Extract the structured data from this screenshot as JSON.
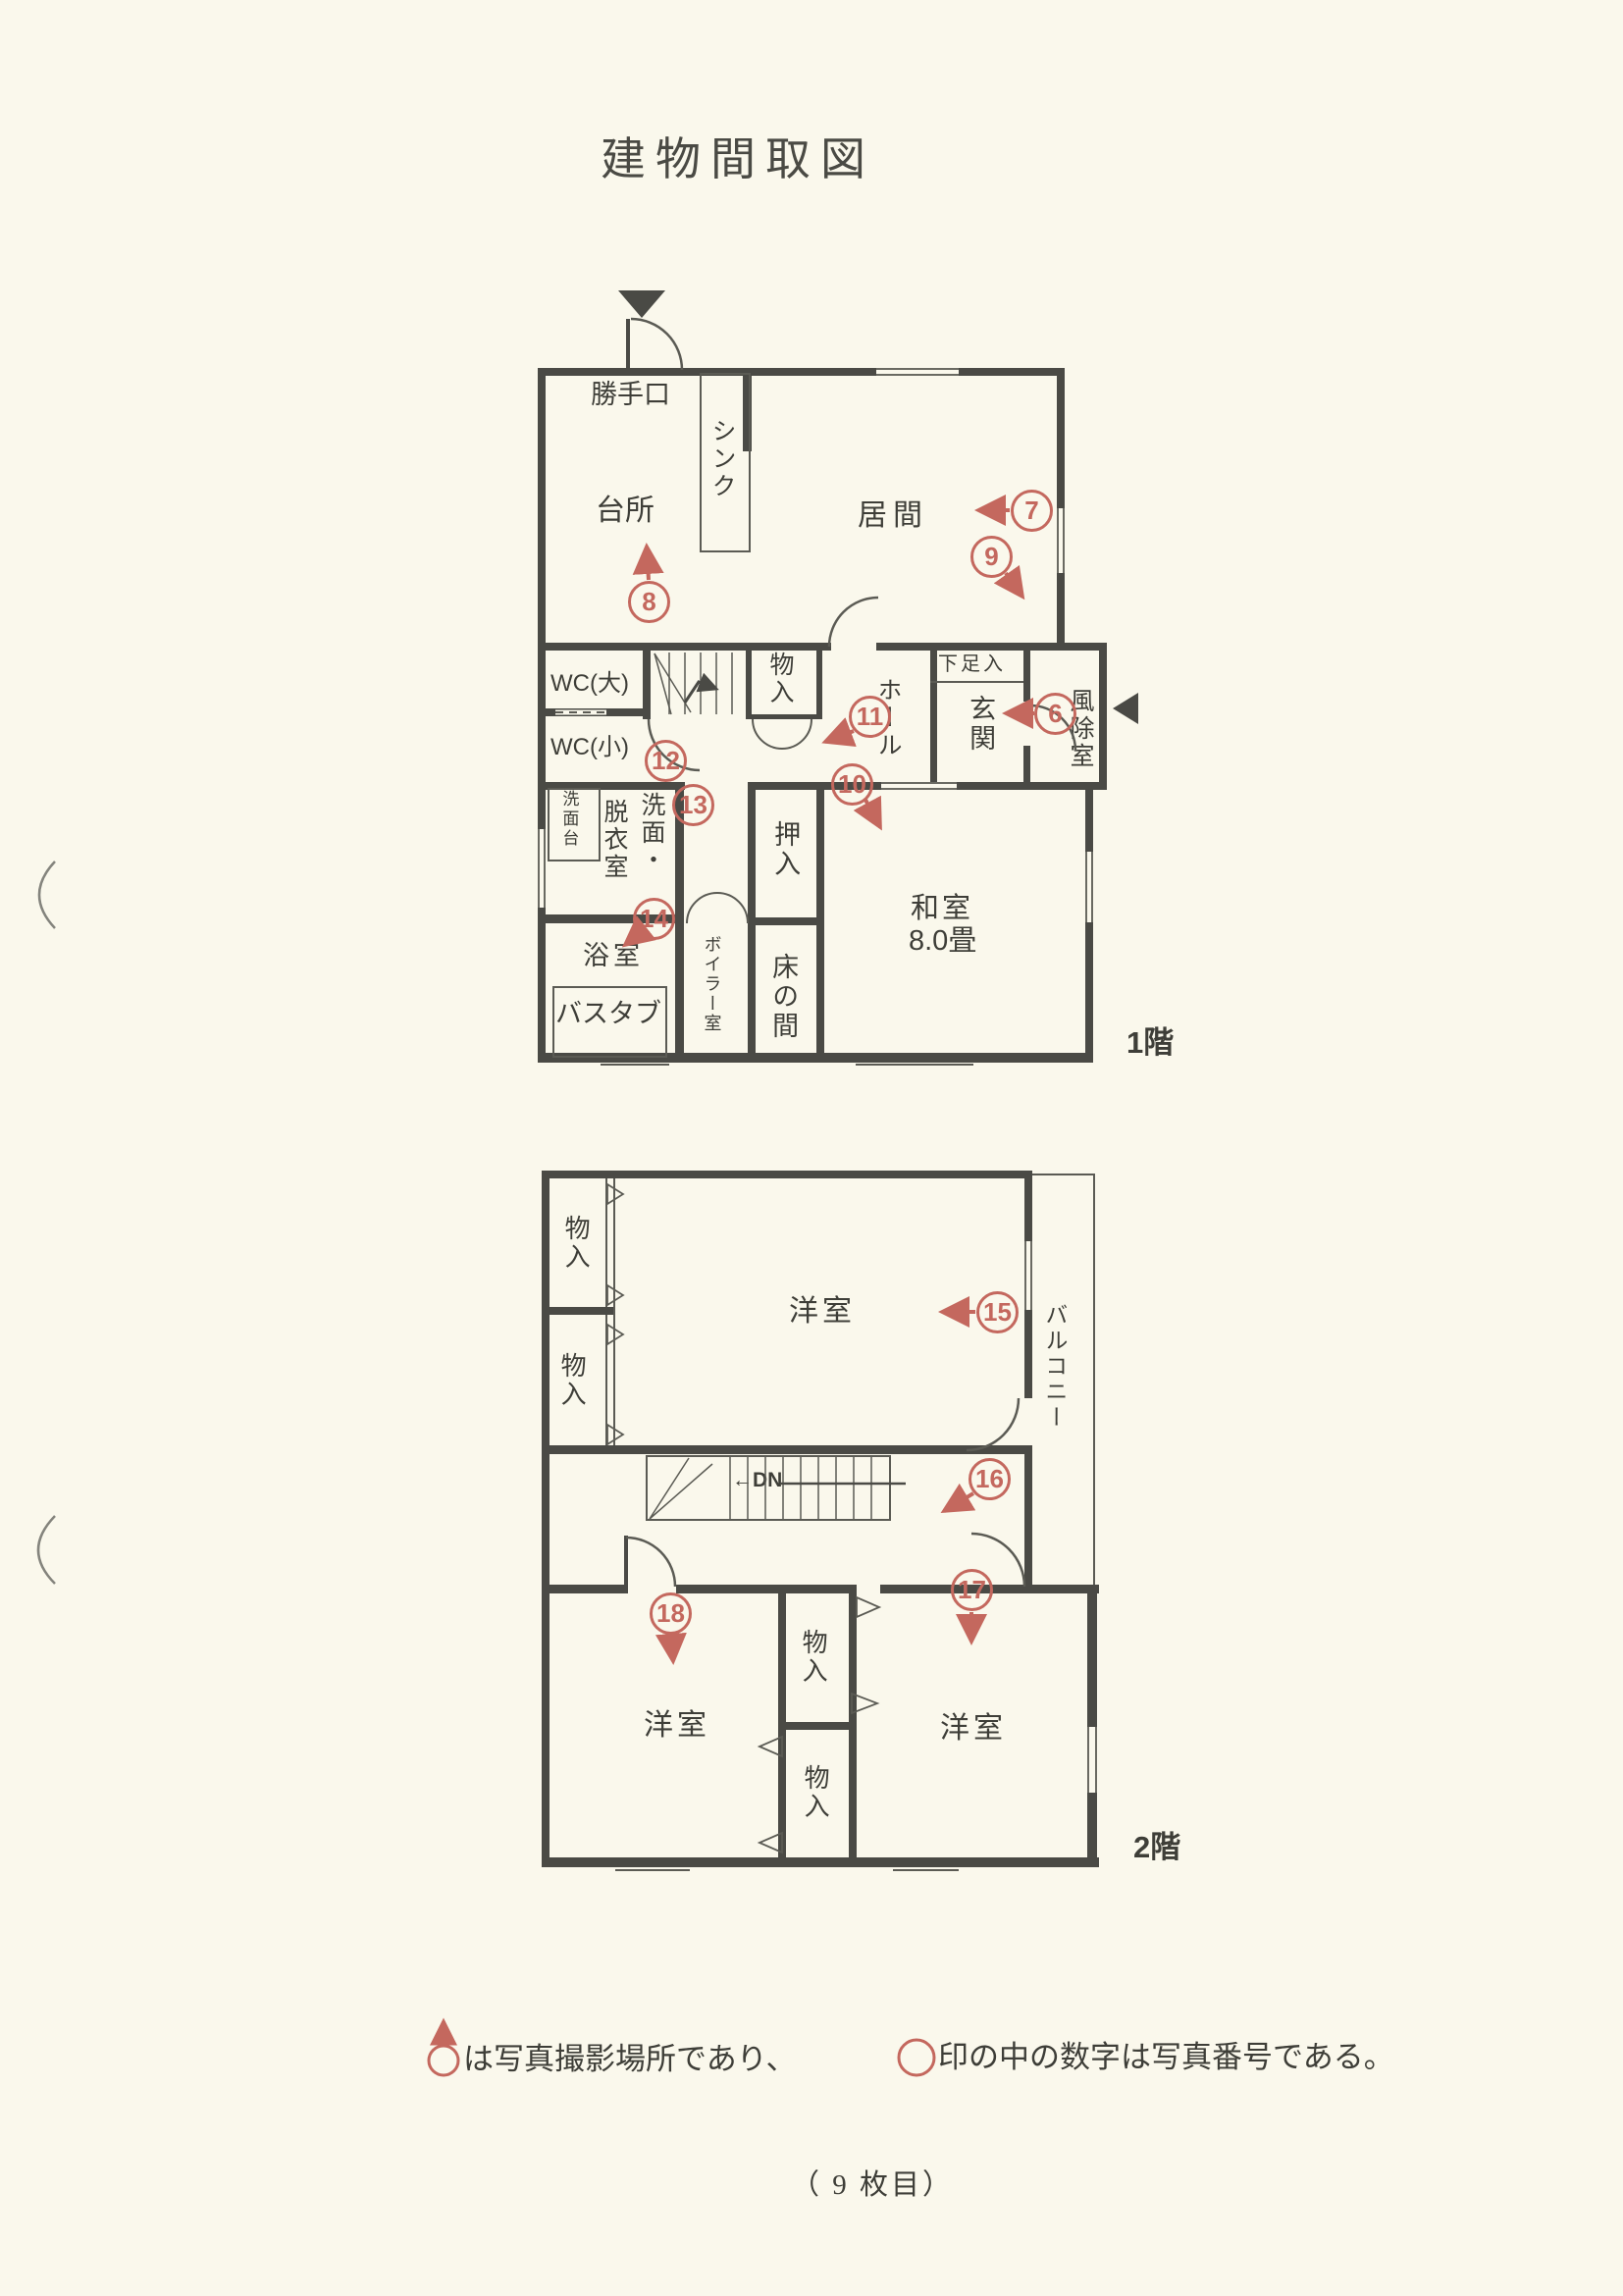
{
  "colors": {
    "paper": "#faf8ec",
    "ink": "#3e3e38",
    "wall": "#4a4a45",
    "red": "#c4685e"
  },
  "title": "建物間取図",
  "floor1": {
    "label": "1階",
    "labels": {
      "katteguchi": "勝手口",
      "sink": "シンク",
      "kitchen": "台所",
      "living": "居間",
      "wc_large": "WC(大)",
      "wc_small": "WC(小)",
      "storage": "物入",
      "hall": "ホール",
      "shoe_box": "下足入",
      "entrance": "玄関",
      "windbreak": "風除室",
      "washstand": "洗面台",
      "washroom_col_right": "洗面・",
      "washroom_col_left": "脱衣室",
      "bath": "浴室",
      "bathtub": "バスタブ",
      "boiler": "ボイラー室",
      "oshiire": "押入",
      "tokonoma": "床の間",
      "washitsu": "和室",
      "washitsu_size": "8.0畳"
    }
  },
  "floor2": {
    "label": "2階",
    "labels": {
      "storage_nw1": "物入",
      "storage_nw2": "物入",
      "yoshitsu_main": "洋室",
      "balcony": "バルコニー",
      "stairs_dn": "←DN",
      "yoshitsu_sw": "洋室",
      "yoshitsu_se": "洋室",
      "storage_c1": "物入",
      "storage_c2": "物入"
    }
  },
  "markers": {
    "m6": "6",
    "m7": "7",
    "m8": "8",
    "m9": "9",
    "m10": "10",
    "m11": "11",
    "m12": "12",
    "m13": "13",
    "m14": "14",
    "m15": "15",
    "m16": "16",
    "m17": "17",
    "m18": "18"
  },
  "legend": {
    "text1": "は写真撮影場所であり、",
    "text2": "印の中の数字は写真番号である。"
  },
  "page_number": "（ 9 枚目）"
}
